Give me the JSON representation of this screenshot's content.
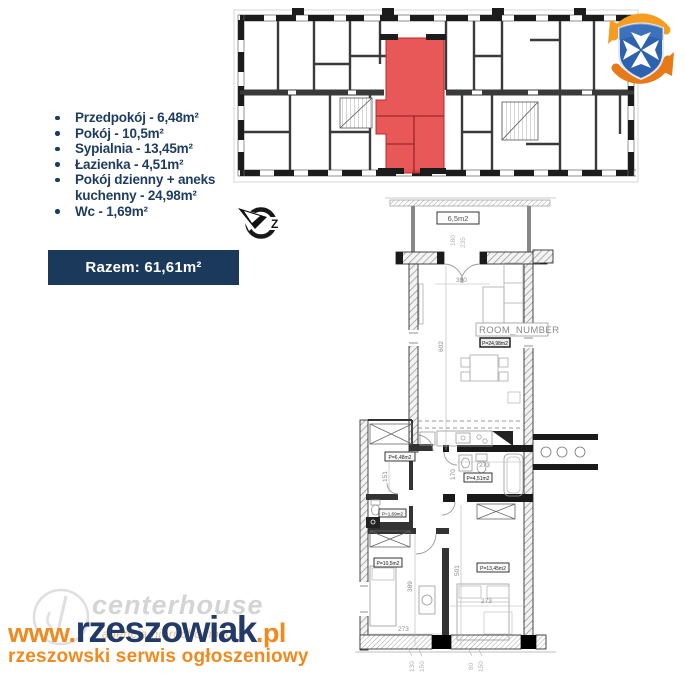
{
  "palette": {
    "navy": "#1e3c5f",
    "banner_bg": "#1b395a",
    "orange": "#f08a1e",
    "highlight_red": "#e64a4a",
    "logo_blue": "#2f62ae",
    "logo_orange_light": "#f59d20",
    "logo_orange_dark": "#e87917"
  },
  "summary": {
    "items": [
      "Przedpokój - 6,48m²",
      "Pokój - 10,5m²",
      "Sypialnia - 13,45m²",
      "Łazienka - 4,51m²",
      "Pokój dzienny + aneks kuchenny - 24,98m²",
      "Wc - 1,69m²"
    ],
    "total": "Razem: 61,61m²"
  },
  "north_arrow": {
    "letter": "Z"
  },
  "floor_plan": {
    "labels": {
      "balcony": "6,5m2",
      "room_number": "ROOM_NUMBER",
      "living": "P=24,98m2",
      "hall": "P=6,48m2",
      "bathroom": "P=4,51m2",
      "wc": "P=1,69m2",
      "room": "P=10,5m2",
      "bedroom": "P=13,45m2"
    },
    "dimensions": {
      "d390": "390",
      "d602": "602",
      "d180": "180",
      "d235": "235",
      "d151": "151",
      "d170": "170",
      "d273a": "273",
      "d273b": "273",
      "d273c": "273",
      "d501": "501",
      "d389": "389",
      "d130": "130",
      "d150a": "150",
      "d80": "80",
      "d150b": "150"
    }
  },
  "watermark": {
    "ghost_brand": "centerhouse",
    "ghost_sub": "agencja nieruchomości",
    "url_prefix": "www.",
    "url_main": "rzeszowiak",
    "url_suffix": ".pl",
    "tagline": "rzeszowski serwis ogłoszeniowy"
  }
}
